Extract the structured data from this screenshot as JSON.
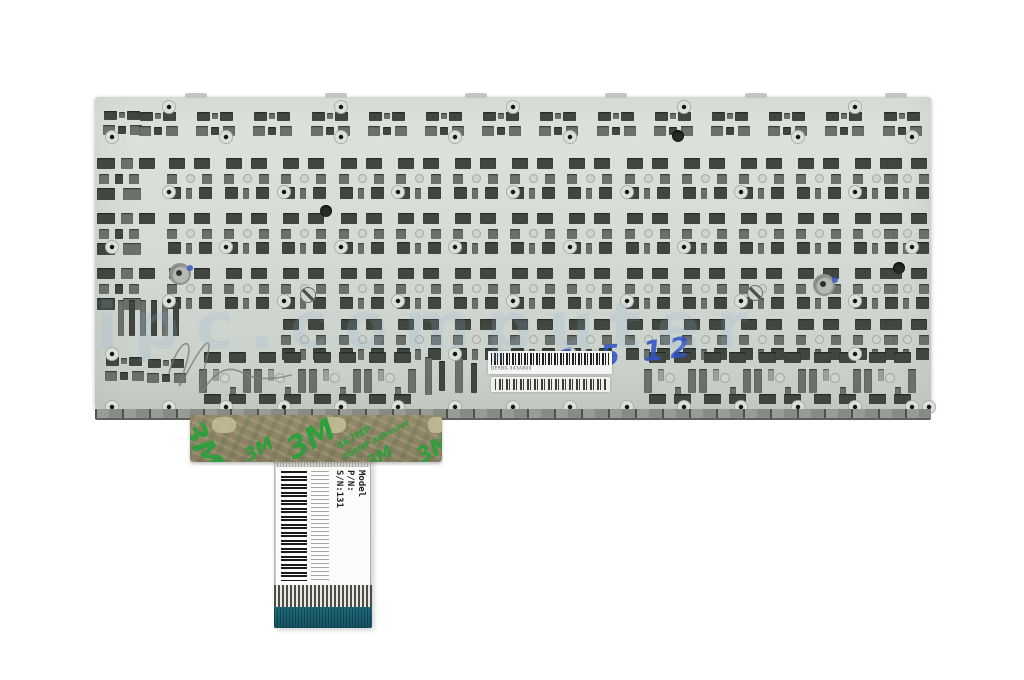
{
  "photo": {
    "subject": "Rear metal backplate of a laptop keyboard with adhesive tape and ribbon cable",
    "background_color": "#ffffff"
  },
  "watermark": {
    "text": "ipc.computer",
    "color": "#8fb3d9"
  },
  "plate": {
    "surface_color": "#d6dbd4",
    "barcode_label": {
      "text": "DERB0-343A800"
    },
    "handwritten_mark": {
      "text": "1 5 12",
      "color": "#2f55c8"
    }
  },
  "tape": {
    "brand": "3M",
    "product": "467MP",
    "descriptor": "200MP Adhesive",
    "print_color": "#2f9e3c"
  },
  "cable": {
    "label": {
      "lines": [
        "Model",
        "P/N:",
        "S/N:131"
      ]
    },
    "stiffener_color": "#1d6372"
  }
}
